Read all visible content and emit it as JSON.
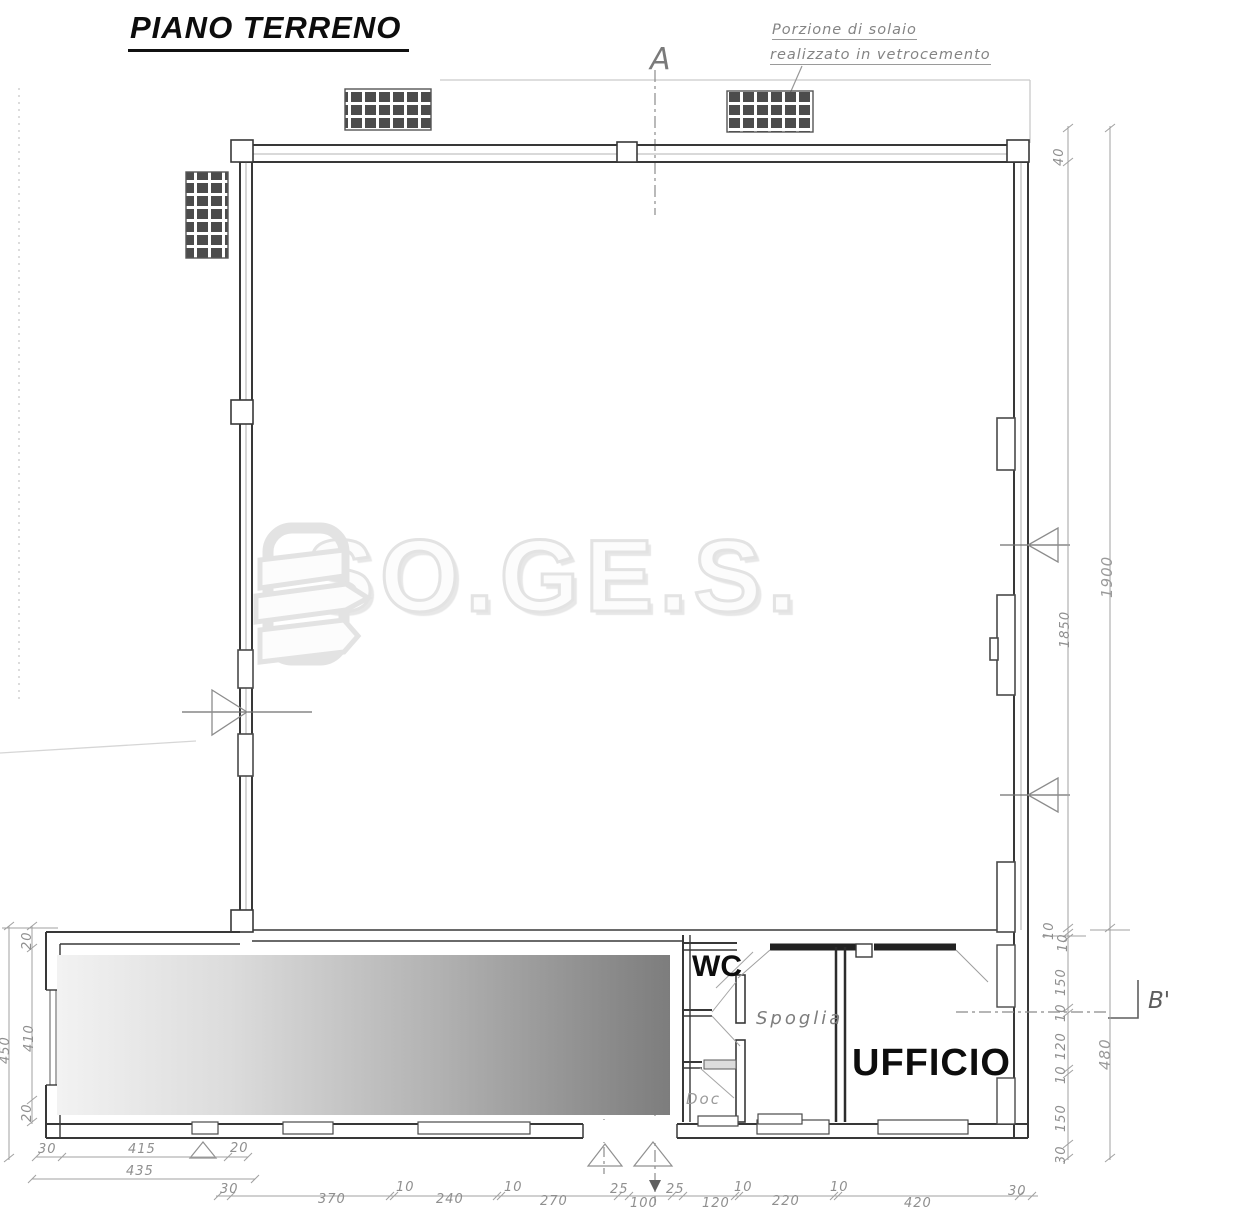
{
  "header": {
    "title": "PIANO TERRENO"
  },
  "note": {
    "line1": "Porzione di solaio",
    "line2": "realizzato in vetrocemento"
  },
  "sections": {
    "a_label": "A",
    "b_label": "B'"
  },
  "rooms": {
    "wc": "WC",
    "spoglia": "Spoglia",
    "ufficio": "UFFICIO",
    "doc": "Doc"
  },
  "watermark": {
    "text": "SO.GE.S."
  },
  "dims": {
    "right": [
      "40",
      "1900",
      "1850",
      "10",
      "10",
      "150",
      "10",
      "120",
      "10",
      "480",
      "150",
      "30"
    ],
    "bottom": [
      "30",
      "370",
      "10",
      "240",
      "10",
      "270",
      "25",
      "100",
      "25",
      "120",
      "10",
      "220",
      "10",
      "420",
      "30"
    ],
    "left": [
      "20",
      "410",
      "20",
      "450"
    ],
    "annex": [
      "30",
      "415",
      "20",
      "435"
    ]
  },
  "colors": {
    "wall": "#383838",
    "dim": "#9b9b9b",
    "watermark_outline": "#e3e3e3"
  }
}
